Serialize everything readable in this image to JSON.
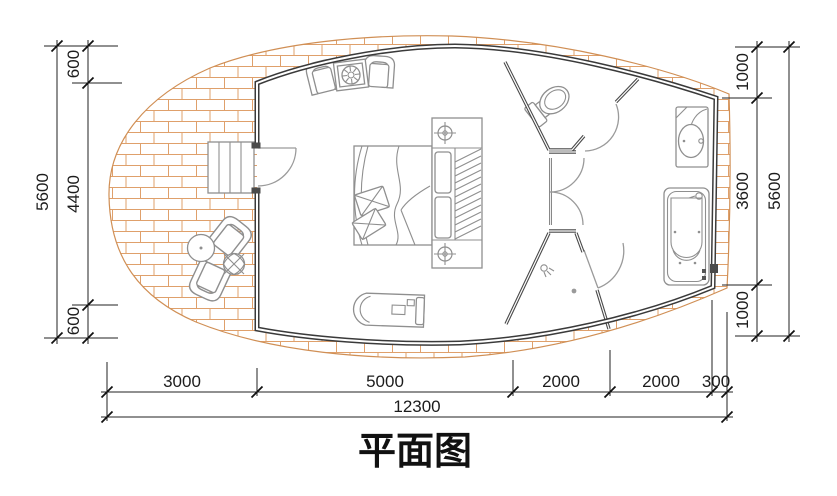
{
  "title": "平面图",
  "dims": {
    "left": {
      "total": "5600",
      "segments": [
        "600",
        "4400",
        "600"
      ]
    },
    "right": {
      "total": "5600",
      "segments": [
        "1000",
        "3600",
        "1000"
      ]
    },
    "bottom": {
      "total": "12300",
      "segments": [
        "3000",
        "5000",
        "2000",
        "2000",
        "300"
      ]
    }
  },
  "icons": [
    "stairs",
    "entry-door",
    "armchair",
    "coffee-table",
    "round-table",
    "potted-plant",
    "double-bed",
    "pillow",
    "bedside-lamp",
    "wardrobe-hatch",
    "daybed",
    "double-doors",
    "toilet",
    "shower-head",
    "floor-drain",
    "wash-basin",
    "bathtub",
    "brick-deck"
  ],
  "colors": {
    "brick_line": "#dfa06b",
    "deck_outline": "#d08f55",
    "wall": "#3a3a3a",
    "partition": "#4a4a4a",
    "furniture_line": "#8f8f8f",
    "dimension": "#1c1c1c",
    "background": "#ffffff"
  }
}
